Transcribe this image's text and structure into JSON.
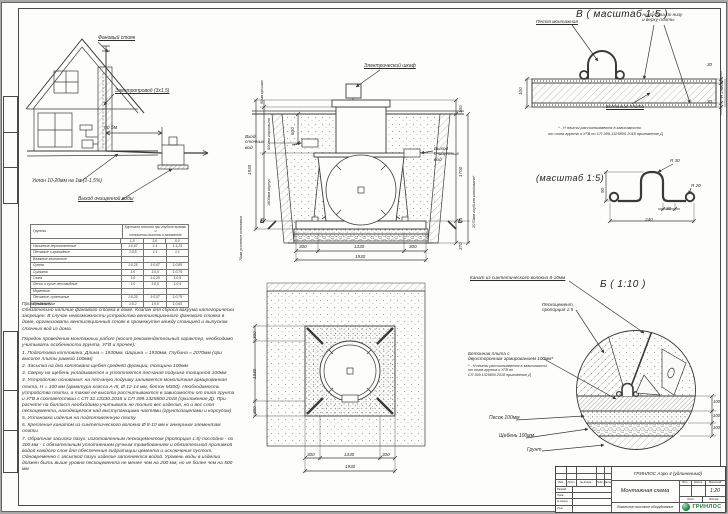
{
  "house": {
    "vent_stack": "Фановый стояк",
    "wire": "Электропровод (3х1,5)",
    "per5m": "по 5м",
    "slope": "Уклон 10-20мм на 1м (1-1,5%)",
    "clean_out": "Выход очищенной воды"
  },
  "section": {
    "cabinet": "Электрический шкаф",
    "inlet": [
      "Вход",
      "сточных",
      "вод"
    ],
    "outlet": [
      "Выход",
      "очищенных",
      "вод"
    ],
    "dim_600": "600",
    "dim_total_h": "1930",
    "dim_body": "1800мм корпус",
    "dim_neck": "500мм горловина",
    "dim_lid": "60мм крышка",
    "dim_base": "70мм усиление основания",
    "dim_100": "100",
    "dim_1700": "1700",
    "dim_370": "370",
    "dim_pit": "2070мм глубина котлована*",
    "dim_b300l": "300",
    "dim_b1330": "1330",
    "dim_b300r": "300",
    "dim_btotal": "1930",
    "marker": "Б"
  },
  "plan": {
    "left": [
      "300",
      "1330",
      "300"
    ],
    "bottom": [
      "300",
      "1330",
      "300"
    ],
    "total": "1930"
  },
  "detail_v": {
    "title": "В ( масштаб 1:5 )",
    "loop": "Петля монтажная",
    "rebar1": "Арматура по низу",
    "rebar2": "и верху плиты",
    "plate": "Бетонная плита",
    "dim_100": "100",
    "dim_30t": "30",
    "dim_30b": "30",
    "dim_h": "Н плиты*",
    "foot1": "* - Н плиты рассчитывается в зависимости",
    "foot2": "от типа грунта и УГВ по СП 399.1325800.2018 приложение Д"
  },
  "detail_loop": {
    "title": "(масштаб 1:5)",
    "r30": "R 30",
    "r20": "R 20",
    "d90": "90",
    "d30": "30",
    "d240": "240"
  },
  "detail_b": {
    "title": "Б ( 1:10 )",
    "rope": "Канат из синтетического волокна 8-10мм",
    "pesco1": "Пескоцемент,",
    "pesco2": "пропорция 1:5",
    "plate1": "Бетонная плита с",
    "plate2": "двухсторонним армированием 100мм*",
    "foot1": "* - Н плиты рассчитывается в зависимости",
    "foot2": "от типа грунта и УГВ по",
    "foot3": "СП 399.1325800.2018 приложение Д",
    "sand": "Песок 100мм",
    "gravel": "Щебень 100мм",
    "soil": "Грунт",
    "d1": "100",
    "d2": "100",
    "d3": "100"
  },
  "soils_table": {
    "col1": "Грунты",
    "col2a": "Крутизна откосов при глубине выемки и",
    "col2b": "отношении высоты к заложению",
    "sub": [
      "1,5",
      "3,0",
      "5,0"
    ],
    "rows": [
      [
        "Насыпные неуплотненные",
        "1:0,67",
        "1:1",
        "1:1,25"
      ],
      [
        "Песчаные и гравийные",
        "1:0,5",
        "1:1",
        "1:1"
      ],
      [
        "Влажные глинистые:",
        "",
        "",
        ""
      ],
      [
        "Супесь",
        "1:0,25",
        "1:0,67",
        "1:0,85"
      ],
      [
        "Суглинок",
        "1:0",
        "1:0,5",
        "1:0,75"
      ],
      [
        "Глина",
        "1:0",
        "1:0,25",
        "1:0,5"
      ],
      [
        "Лессы и сухие лессовидные",
        "1:0",
        "1:0,5",
        "1:0,5"
      ],
      [
        "Моренные:",
        "",
        "",
        ""
      ],
      [
        "Песчаные, супесчаные",
        "1:0,25",
        "1:0,57",
        "1:0,75"
      ],
      [
        "Суглинистые",
        "1:0,2",
        "1:0,5",
        "1:0,65"
      ]
    ]
  },
  "notes": {
    "remark_title": "Примечание:",
    "remark": "Обязательно наличие фанового стояка в доме. Клапан для сброса вакуума категорически запрещен. В случае невозможности устройства вентиляционного фанового стояка в доме, организовать вентиляционный стояк в промежутке между станцией и выпуском сточных вод из дома.",
    "order_title": "Порядок проведения монтажных работ (носит рекомендательный характер, необходимо учитывать особенности грунта, УГВ и прочее):",
    "items": [
      "1. Подготовка котлована: Длина = 1930мм, Ширина = 1930мм, Глубина = 2070мм (при высоте плиты равной 100мм)",
      "2. Засыпка на дно котлована щебня средней фракции, толщина 100мм",
      "3. Сверху на щебень укладывается и уплотняется песчаная подушка толщиной 100мм",
      "4. Устройство основания: на песчаную подушку заливается монолитная армированная плита, Н = 100 мм (арматура класса А-III, Ø 12-14 мм, бетон М300). Необходимость устройства плиты, а также её высота рассчитываются в зависимости от типа грунта и УГВ в соответствии с СП 32.13330.2018 и СП 399.1325800.2018 (приложение Д). При расчете на балласт необходимо учитывать не только вес изделия, но и вес слоя пескоцемента, находящегося над выступающими частями (грунтозацепами и корпусом)",
      "5. Установка изделия на подготовленную плиту",
      "6. Крепление канатом из синтетического волокна Ø 8-10 мм к анкерным элементам плиты",
      "7. Обратная засыпка пазух: изготовленным пескоцементом (пропорция 1:5) послойно - по 300 мм - с обязательным уплотнением ручным трамбованием и обязательной проливкой водой каждого слоя для обеспечения гидратации цемента и исключения пустот. Одновременно с засыпкой пазух изделие заполняется водой. Уровень воды в изделии должен быть выше уровня пескоцемента не менее чем на 200 мм, но не более чем на 500 мм"
    ]
  },
  "titleblock": {
    "product": "ГРИНЛОС Аэро 4 (удлиненный)",
    "doc_name": "Монтажная схема",
    "company": "Локальное очистное оборудование",
    "logo_text": "ГРИНЛОС",
    "scale_value": "1:20",
    "lit": "Лит.",
    "massa": "Масса",
    "masshtab": "Масштаб",
    "list": "Лист",
    "listov": "Листов",
    "rev_cols": [
      "Изм.",
      "Лист",
      "№ докум.",
      "Подп.",
      "Дата"
    ],
    "roles": [
      "Разраб.",
      "Пров.",
      "Н.контр.",
      "Утв."
    ]
  }
}
